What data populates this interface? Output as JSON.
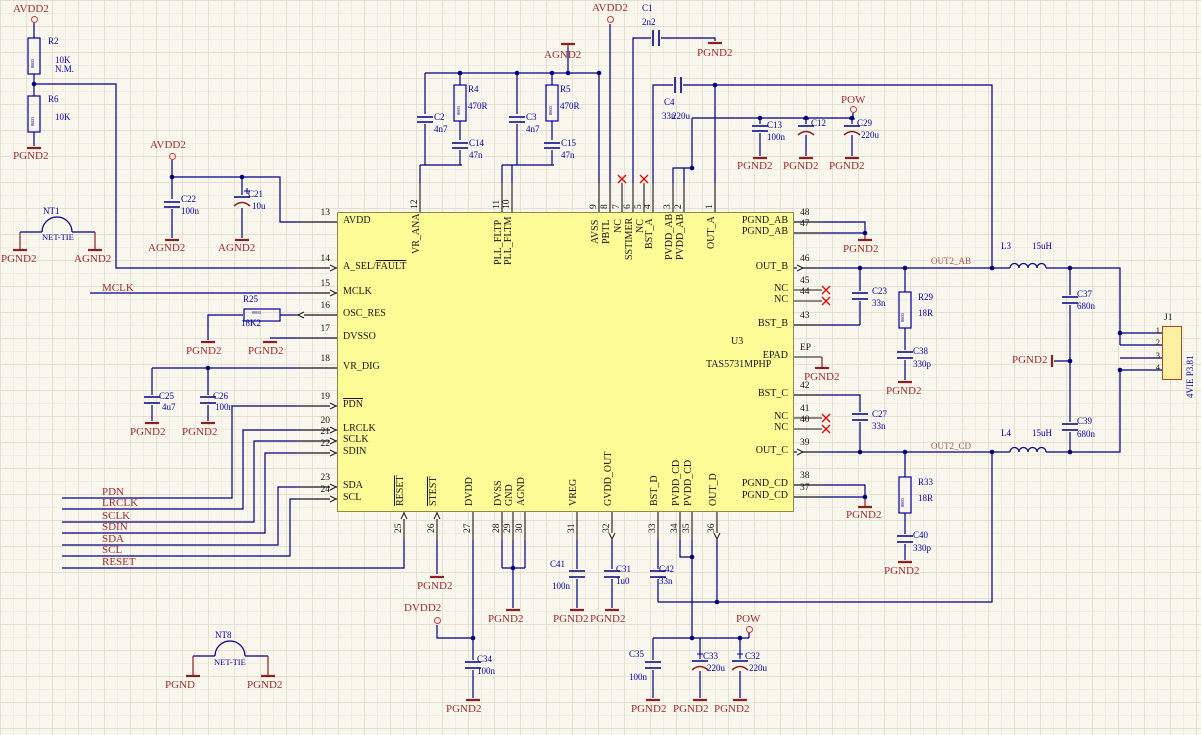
{
  "schematic": {
    "ic": {
      "ref": "U3",
      "part": "TAS5731MPHP",
      "pins_left": [
        {
          "num": "13",
          "name": "AVDD",
          "y": 222
        },
        {
          "num": "14",
          "name": "A_SEL/",
          "ov": "FAULT",
          "y": 268,
          "ar": "r"
        },
        {
          "num": "15",
          "name": "MCLK",
          "y": 293,
          "ar": "r"
        },
        {
          "num": "16",
          "name": "OSC_RES",
          "y": 315,
          "ar": "l"
        },
        {
          "num": "17",
          "name": "DVSSO",
          "y": 338
        },
        {
          "num": "18",
          "name": "VR_DIG",
          "y": 368
        },
        {
          "num": "19",
          "name": "",
          "ov": "PDN",
          "y": 406,
          "ar": "r"
        },
        {
          "num": "20",
          "name": "LRCLK",
          "y": 430,
          "ar": "r"
        },
        {
          "num": "21",
          "name": "SCLK",
          "y": 441,
          "ar": "r"
        },
        {
          "num": "22",
          "name": "SDIN",
          "y": 453,
          "ar": "r"
        },
        {
          "num": "23",
          "name": "SDA",
          "y": 487,
          "ar": "r"
        },
        {
          "num": "24",
          "name": "SCL",
          "y": 499,
          "ar": "r"
        }
      ],
      "pins_right": [
        {
          "num": "48",
          "name": "PGND_AB",
          "y": 222
        },
        {
          "num": "47",
          "name": "PGND_AB",
          "y": 233
        },
        {
          "num": "46",
          "name": "OUT_B",
          "y": 268,
          "ar": "r"
        },
        {
          "num": "45",
          "name": "NC",
          "y": 290,
          "nc": true
        },
        {
          "num": "44",
          "name": "NC",
          "y": 301,
          "nc": true
        },
        {
          "num": "43",
          "name": "BST_B",
          "y": 325
        },
        {
          "num": "EP",
          "name": "EPAD",
          "y": 357
        },
        {
          "num": "42",
          "name": "BST_C",
          "y": 395
        },
        {
          "num": "41",
          "name": "NC",
          "y": 418,
          "nc": true
        },
        {
          "num": "40",
          "name": "NC",
          "y": 429,
          "nc": true
        },
        {
          "num": "39",
          "name": "OUT_C",
          "y": 452,
          "ar": "r"
        },
        {
          "num": "38",
          "name": "PGND_CD",
          "y": 485
        },
        {
          "num": "37",
          "name": "PGND_CD",
          "y": 497
        }
      ],
      "pins_top": [
        {
          "num": "12",
          "name": "VR_ANA",
          "x": 420
        },
        {
          "num": "11",
          "name": "PLL_FLTP",
          "x": 502
        },
        {
          "num": "10",
          "name": "PLL_FLTM",
          "x": 512
        },
        {
          "num": "9",
          "name": "AVSS",
          "x": 599
        },
        {
          "num": "8",
          "name": "PBTL",
          "x": 610
        },
        {
          "num": "7",
          "name": "NC",
          "x": 622,
          "nc": true
        },
        {
          "num": "6",
          "name": "SSTIMER",
          "x": 633
        },
        {
          "num": "5",
          "name": "NC",
          "x": 644,
          "nc": true
        },
        {
          "num": "4",
          "name": "BST_A",
          "x": 653
        },
        {
          "num": "3",
          "name": "PVDD_AB",
          "x": 673
        },
        {
          "num": "2",
          "name": "PVDD_AB",
          "x": 684
        },
        {
          "num": "1",
          "name": "OUT_A",
          "x": 715
        }
      ],
      "pins_bottom": [
        {
          "num": "25",
          "name": "",
          "ov": "RESET",
          "x": 404,
          "ar": "u"
        },
        {
          "num": "26",
          "name": "",
          "ov": "STEST",
          "x": 437,
          "ar": "u"
        },
        {
          "num": "27",
          "name": "DVDD",
          "x": 473
        },
        {
          "num": "28",
          "name": "DVSS",
          "x": 502
        },
        {
          "num": "29",
          "name": "GND",
          "x": 513
        },
        {
          "num": "30",
          "name": "AGND",
          "x": 525
        },
        {
          "num": "31",
          "name": "VREG",
          "x": 577
        },
        {
          "num": "32",
          "name": "GVDD_OUT",
          "x": 612,
          "ar": "d"
        },
        {
          "num": "33",
          "name": "BST_D",
          "x": 658
        },
        {
          "num": "34",
          "name": "PVDD_CD",
          "x": 680
        },
        {
          "num": "35",
          "name": "PVDD_CD",
          "x": 692
        },
        {
          "num": "36",
          "name": "OUT_D",
          "x": 717,
          "ar": "d"
        }
      ]
    },
    "connector_j1": {
      "ref": "J1",
      "type_label": "4VIE P3.81",
      "pins": [
        "1",
        "2",
        "3",
        "4"
      ]
    },
    "power_ports": [
      {
        "t": "AVDD2",
        "x": 13,
        "y": 4,
        "cx": 34,
        "cy": 19
      },
      {
        "t": "AVDD2",
        "x": 150,
        "y": 140,
        "cx": 172,
        "cy": 156
      },
      {
        "t": "AVDD2",
        "x": 592,
        "y": 3,
        "cx": 610,
        "cy": 19
      },
      {
        "t": "POW",
        "x": 841,
        "y": 95,
        "cx": 853,
        "cy": 109
      },
      {
        "t": "POW",
        "x": 736,
        "y": 614,
        "cx": 749,
        "cy": 629
      },
      {
        "t": "DVDD2",
        "x": 404,
        "y": 603,
        "cx": 437,
        "cy": 620
      }
    ],
    "ground_ports": [
      {
        "t": "PGND2",
        "x": 13,
        "y": 151,
        "bx": 34,
        "by": 148
      },
      {
        "t": "AGND2",
        "x": 148,
        "y": 243,
        "bx": 172,
        "by": 240
      },
      {
        "t": "AGND2",
        "x": 218,
        "y": 243,
        "bx": 242,
        "by": 240
      },
      {
        "t": "PGND2",
        "x": 1,
        "y": 254,
        "bx": 20,
        "by": 250
      },
      {
        "t": "AGND2",
        "x": 74,
        "y": 254,
        "bx": 95,
        "by": 250
      },
      {
        "t": "PGND2",
        "x": 186,
        "y": 346,
        "bx": 208,
        "by": 342
      },
      {
        "t": "PGND2",
        "x": 248,
        "y": 346,
        "bx": 270,
        "by": 342
      },
      {
        "t": "PGND2",
        "x": 130,
        "y": 427,
        "bx": 152,
        "by": 423
      },
      {
        "t": "PGND2",
        "x": 182,
        "y": 427,
        "bx": 208,
        "by": 423
      },
      {
        "t": "AGND2",
        "x": 544,
        "y": 50,
        "bx": 568,
        "by": 44
      },
      {
        "t": "PGND2",
        "x": 697,
        "y": 48,
        "bx": 715,
        "by": 43
      },
      {
        "t": "PGND2",
        "x": 737,
        "y": 161,
        "bx": 760,
        "by": 158
      },
      {
        "t": "PGND2",
        "x": 783,
        "y": 161,
        "bx": 806,
        "by": 158
      },
      {
        "t": "PGND2",
        "x": 829,
        "y": 161,
        "bx": 852,
        "by": 158
      },
      {
        "t": "PGND2",
        "x": 843,
        "y": 244,
        "bx": 865,
        "by": 240
      },
      {
        "t": "PGND2",
        "x": 1012,
        "y": 355,
        "bx": 1052,
        "by": 361,
        "vert": true
      },
      {
        "t": "PGND2",
        "x": 886,
        "y": 386,
        "bx": 905,
        "by": 382
      },
      {
        "t": "PGND2",
        "x": 804,
        "y": 372,
        "bx": 822,
        "by": 368
      },
      {
        "t": "PGND2",
        "x": 846,
        "y": 510,
        "bx": 865,
        "by": 507
      },
      {
        "t": "PGND2",
        "x": 884,
        "y": 566,
        "bx": 905,
        "by": 562
      },
      {
        "t": "PGND2",
        "x": 417,
        "y": 581,
        "bx": 437,
        "by": 577
      },
      {
        "t": "PGND2",
        "x": 488,
        "y": 614,
        "bx": 513,
        "by": 610
      },
      {
        "t": "PGND2",
        "x": 553,
        "y": 614,
        "bx": 577,
        "by": 610
      },
      {
        "t": "PGND2",
        "x": 590,
        "y": 614,
        "bx": 612,
        "by": 610
      },
      {
        "t": "PGND2",
        "x": 446,
        "y": 704,
        "bx": 473,
        "by": 700
      },
      {
        "t": "PGND2",
        "x": 631,
        "y": 704,
        "bx": 653,
        "by": 700
      },
      {
        "t": "PGND2",
        "x": 673,
        "y": 704,
        "bx": 700,
        "by": 700
      },
      {
        "t": "PGND2",
        "x": 714,
        "y": 704,
        "bx": 740,
        "by": 700
      },
      {
        "t": "PGND",
        "x": 165,
        "y": 680,
        "bx": 193,
        "by": 676
      },
      {
        "t": "PGND2",
        "x": 247,
        "y": 680,
        "bx": 268,
        "by": 676
      }
    ],
    "net_labels": [
      {
        "t": "MCLK",
        "x": 102,
        "y": 283
      },
      {
        "t": "PDN",
        "x": 102,
        "y": 487
      },
      {
        "t": "LRCLK",
        "x": 102,
        "y": 498
      },
      {
        "t": "SCLK",
        "x": 102,
        "y": 511
      },
      {
        "t": "SDIN",
        "x": 102,
        "y": 522
      },
      {
        "t": "SDA",
        "x": 102,
        "y": 534
      },
      {
        "t": "SCL",
        "x": 102,
        "y": 545
      },
      {
        "t": "RESET",
        "x": 102,
        "y": 557
      }
    ],
    "output_net_labels": [
      {
        "t": "OUT2_AB",
        "x": 931,
        "y": 257
      },
      {
        "t": "OUT2_CD",
        "x": 931,
        "y": 442
      }
    ],
    "net_ties": [
      {
        "ref": "NT1",
        "label": "NET-TIE",
        "x": 43,
        "y": 207,
        "lx": 42,
        "ly": 233
      },
      {
        "ref": "NT8",
        "label": "NET-TIE",
        "x": 215,
        "y": 631,
        "lx": 214,
        "ly": 658
      }
    ],
    "components": [
      {
        "ref": "R2",
        "rx": 48,
        "ry": 37,
        "val": "10K",
        "vx": 55,
        "vy": 56,
        "note": "N.M.",
        "nx": 55,
        "ny": 65,
        "body": "0803",
        "bx": 31,
        "by": 68,
        "brot": true
      },
      {
        "ref": "R6",
        "rx": 48,
        "ry": 95,
        "val": "10K",
        "vx": 55,
        "vy": 113,
        "body": "0803",
        "bx": 31,
        "by": 126,
        "brot": true
      },
      {
        "ref": "R4",
        "rx": 468,
        "ry": 85,
        "val": "470R",
        "vx": 468,
        "vy": 102,
        "body": "0803",
        "bx": 457,
        "by": 115,
        "brot": true
      },
      {
        "ref": "R5",
        "rx": 560,
        "ry": 85,
        "val": "470R",
        "vx": 560,
        "vy": 102,
        "body": "0803",
        "bx": 549,
        "by": 115,
        "brot": true
      },
      {
        "ref": "R25",
        "rx": 243,
        "ry": 295,
        "val": "18K2",
        "vx": 241,
        "vy": 319,
        "body": "0803",
        "bx": 252,
        "by": 311
      },
      {
        "ref": "R29",
        "rx": 918,
        "ry": 293,
        "val": "18R",
        "vx": 918,
        "vy": 309,
        "body": "0803",
        "bx": 901,
        "by": 322,
        "brot": true
      },
      {
        "ref": "R33",
        "rx": 918,
        "ry": 478,
        "val": "18R",
        "vx": 918,
        "vy": 494,
        "body": "0803",
        "bx": 901,
        "by": 507,
        "brot": true
      },
      {
        "ref": "C22",
        "rx": 181,
        "ry": 195,
        "val": "100n",
        "vx": 181,
        "vy": 207
      },
      {
        "ref": "C21",
        "rx": 248,
        "ry": 190,
        "val": "10u",
        "vx": 252,
        "vy": 202
      },
      {
        "ref": "C2",
        "rx": 434,
        "ry": 113,
        "val": "4n7",
        "vx": 434,
        "vy": 125
      },
      {
        "ref": "C14",
        "rx": 469,
        "ry": 139,
        "val": "47n",
        "vx": 469,
        "vy": 151
      },
      {
        "ref": "C3",
        "rx": 526,
        "ry": 113,
        "val": "4n7",
        "vx": 526,
        "vy": 125
      },
      {
        "ref": "C15",
        "rx": 561,
        "ry": 139,
        "val": "47n",
        "vx": 561,
        "vy": 151
      },
      {
        "ref": "C1",
        "rx": 642,
        "ry": 4,
        "val": "2n2",
        "vx": 642,
        "vy": 18
      },
      {
        "ref": "C4",
        "rx": 664,
        "ry": 98,
        "val": "33n",
        "vx": 662,
        "vy": 112,
        "note": "220u",
        "nx": 672,
        "ny": 112
      },
      {
        "ref": "C13",
        "rx": 767,
        "ry": 121,
        "val": "100n",
        "vx": 767,
        "vy": 133
      },
      {
        "ref": "C12",
        "rx": 811,
        "ry": 119
      },
      {
        "ref": "C29",
        "rx": 857,
        "ry": 119,
        "val": "220u",
        "vx": 861,
        "vy": 131
      },
      {
        "ref": "C23",
        "rx": 872,
        "ry": 287,
        "val": "33n",
        "vx": 872,
        "vy": 299
      },
      {
        "ref": "C38",
        "rx": 913,
        "ry": 347,
        "val": "330p",
        "vx": 913,
        "vy": 360
      },
      {
        "ref": "C27",
        "rx": 872,
        "ry": 410,
        "val": "33n",
        "vx": 872,
        "vy": 422
      },
      {
        "ref": "C40",
        "rx": 913,
        "ry": 531,
        "val": "330p",
        "vx": 913,
        "vy": 544
      },
      {
        "ref": "C37",
        "rx": 1077,
        "ry": 290,
        "val": "680n",
        "vx": 1077,
        "vy": 302
      },
      {
        "ref": "C39",
        "rx": 1077,
        "ry": 417,
        "val": "680n",
        "vx": 1077,
        "vy": 430
      },
      {
        "ref": "C25",
        "rx": 159,
        "ry": 392,
        "val": "4u7",
        "vx": 162,
        "vy": 403
      },
      {
        "ref": "C26",
        "rx": 213,
        "ry": 392,
        "val": "100n",
        "vx": 215,
        "vy": 403
      },
      {
        "ref": "C41",
        "rx": 550,
        "ry": 560,
        "val": "100n",
        "vx": 552,
        "vy": 582
      },
      {
        "ref": "C31",
        "rx": 616,
        "ry": 565,
        "val": "1u0",
        "vx": 616,
        "vy": 577
      },
      {
        "ref": "C42",
        "rx": 659,
        "ry": 565,
        "val": "33n",
        "vx": 659,
        "vy": 577
      },
      {
        "ref": "C34",
        "rx": 477,
        "ry": 655,
        "val": "100n",
        "vx": 477,
        "vy": 667
      },
      {
        "ref": "C35",
        "rx": 629,
        "ry": 650,
        "val": "100n",
        "vx": 629,
        "vy": 673
      },
      {
        "ref": "C33",
        "rx": 703,
        "ry": 652,
        "val": "220u",
        "vx": 707,
        "vy": 664
      },
      {
        "ref": "C32",
        "rx": 745,
        "ry": 652,
        "val": "220u",
        "vx": 749,
        "vy": 664
      },
      {
        "ref": "L3",
        "rx": 1001,
        "ry": 242,
        "val": "15uH",
        "vx": 1032,
        "vy": 242
      },
      {
        "ref": "L4",
        "rx": 1001,
        "ry": 429,
        "val": "15uH",
        "vx": 1032,
        "vy": 429
      }
    ]
  }
}
